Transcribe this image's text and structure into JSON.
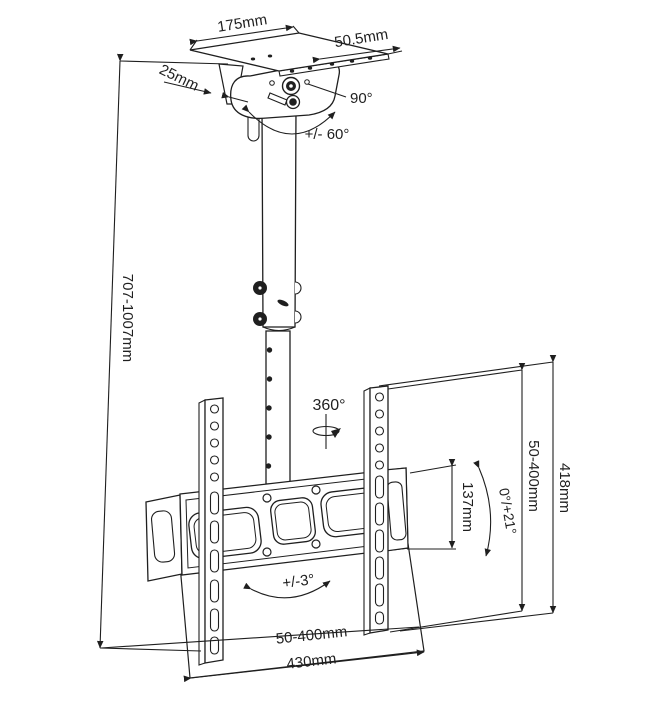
{
  "diagram": {
    "type": "technical-drawing",
    "subject": "ceiling TV mount dimension diagram",
    "colors": {
      "line": "#1f1f1f",
      "background": "#ffffff",
      "text": "#1f1f1f"
    },
    "labels": {
      "plate_width": "175mm",
      "plate_depth": "50.5mm",
      "plate_edge": "25mm",
      "swivel_angle": "90°",
      "swivel_range": "+/- 60°",
      "height_range": "707-1007mm",
      "rotation": "360°",
      "vesa_vertical_range": "50-400mm",
      "total_height": "418mm",
      "bracket_height": "137mm",
      "tilt_range": "0°/+21°",
      "level_range": "+/-3°",
      "vesa_horizontal_range": "50-400mm",
      "total_width": "430mm"
    }
  }
}
